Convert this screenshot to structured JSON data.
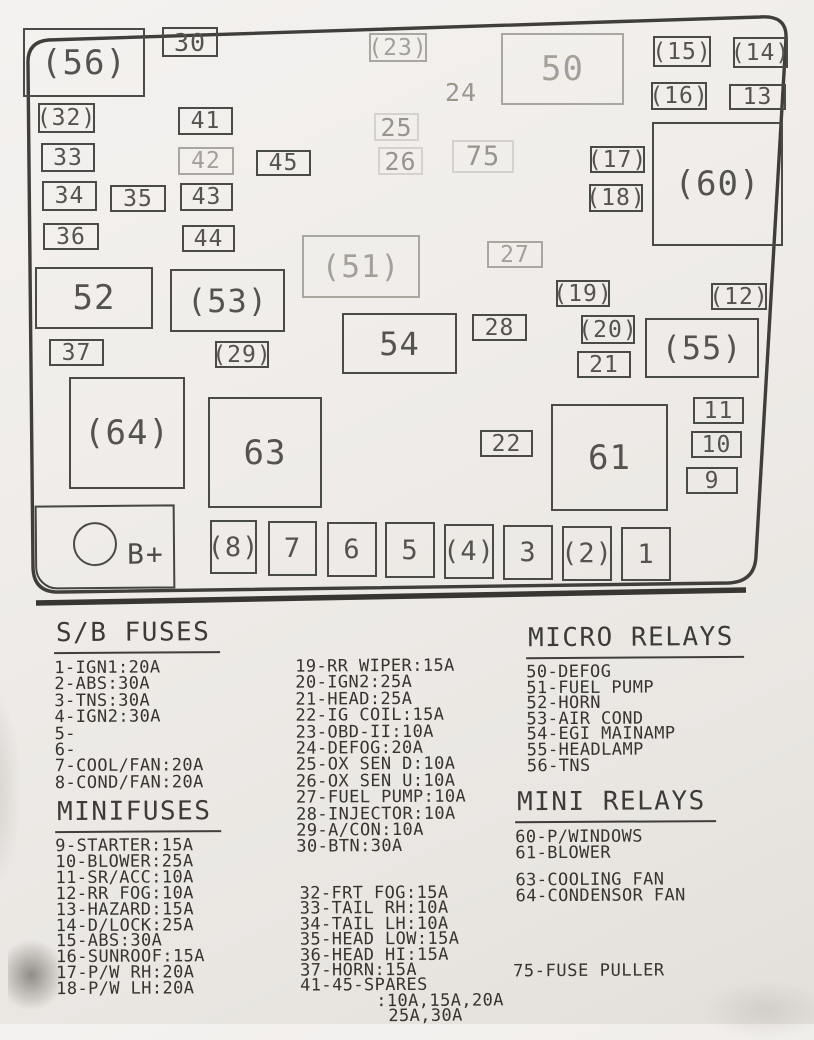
{
  "colors": {
    "ink": "#3f3d3a",
    "faint_ink": "#a3a09a",
    "paper": "#efece9"
  },
  "diagram": {
    "battery_label": "B+",
    "boxes": [
      {
        "label": "(56)",
        "x": 23,
        "y": 28,
        "w": 122,
        "h": 69,
        "fs": 34
      },
      {
        "label": "30",
        "x": 162,
        "y": 27,
        "w": 56,
        "h": 30,
        "fs": 25
      },
      {
        "label": "(23)",
        "x": 369,
        "y": 33,
        "w": 58,
        "h": 29,
        "fs": 23,
        "variant": "faint"
      },
      {
        "label": "24",
        "x": 440,
        "y": 78,
        "w": 42,
        "h": 28,
        "fs": 25,
        "variant": "text"
      },
      {
        "label": "50",
        "x": 501,
        "y": 33,
        "w": 123,
        "h": 72,
        "fs": 34,
        "variant": "faint"
      },
      {
        "label": "(15)",
        "x": 653,
        "y": 36,
        "w": 58,
        "h": 31,
        "fs": 23
      },
      {
        "label": "(14)",
        "x": 733,
        "y": 37,
        "w": 55,
        "h": 31,
        "fs": 23
      },
      {
        "label": "(16)",
        "x": 651,
        "y": 82,
        "w": 56,
        "h": 28,
        "fs": 23
      },
      {
        "label": "13",
        "x": 729,
        "y": 84,
        "w": 57,
        "h": 26,
        "fs": 23
      },
      {
        "label": "(32)",
        "x": 38,
        "y": 103,
        "w": 57,
        "h": 30,
        "fs": 23
      },
      {
        "label": "41",
        "x": 178,
        "y": 107,
        "w": 55,
        "h": 28,
        "fs": 23
      },
      {
        "label": "25",
        "x": 374,
        "y": 113,
        "w": 45,
        "h": 28,
        "fs": 25,
        "variant": "ghost"
      },
      {
        "label": "33",
        "x": 41,
        "y": 143,
        "w": 54,
        "h": 29,
        "fs": 23
      },
      {
        "label": "42",
        "x": 178,
        "y": 147,
        "w": 56,
        "h": 28,
        "fs": 23,
        "variant": "faint"
      },
      {
        "label": "45",
        "x": 256,
        "y": 150,
        "w": 55,
        "h": 26,
        "fs": 23
      },
      {
        "label": "26",
        "x": 378,
        "y": 147,
        "w": 45,
        "h": 28,
        "fs": 25,
        "variant": "ghost"
      },
      {
        "label": "75",
        "x": 452,
        "y": 140,
        "w": 62,
        "h": 33,
        "fs": 27,
        "variant": "ghost"
      },
      {
        "label": "(17)",
        "x": 590,
        "y": 146,
        "w": 55,
        "h": 27,
        "fs": 23
      },
      {
        "label": "(60)",
        "x": 652,
        "y": 122,
        "w": 131,
        "h": 124,
        "fs": 34
      },
      {
        "label": "34",
        "x": 42,
        "y": 181,
        "w": 55,
        "h": 30,
        "fs": 23
      },
      {
        "label": "35",
        "x": 110,
        "y": 185,
        "w": 56,
        "h": 27,
        "fs": 23
      },
      {
        "label": "43",
        "x": 180,
        "y": 183,
        "w": 53,
        "h": 28,
        "fs": 23
      },
      {
        "label": "(18)",
        "x": 589,
        "y": 184,
        "w": 54,
        "h": 28,
        "fs": 23
      },
      {
        "label": "36",
        "x": 43,
        "y": 223,
        "w": 56,
        "h": 27,
        "fs": 23
      },
      {
        "label": "44",
        "x": 182,
        "y": 225,
        "w": 53,
        "h": 27,
        "fs": 23
      },
      {
        "label": "(51)",
        "x": 302,
        "y": 235,
        "w": 118,
        "h": 63,
        "fs": 31,
        "variant": "faint"
      },
      {
        "label": "27",
        "x": 487,
        "y": 241,
        "w": 56,
        "h": 27,
        "fs": 23,
        "variant": "faint"
      },
      {
        "label": "52",
        "x": 35,
        "y": 267,
        "w": 118,
        "h": 62,
        "fs": 34
      },
      {
        "label": "(53)",
        "x": 170,
        "y": 269,
        "w": 115,
        "h": 63,
        "fs": 32
      },
      {
        "label": "(19)",
        "x": 556,
        "y": 280,
        "w": 54,
        "h": 27,
        "fs": 23
      },
      {
        "label": "(12)",
        "x": 711,
        "y": 283,
        "w": 56,
        "h": 27,
        "fs": 23
      },
      {
        "label": "28",
        "x": 472,
        "y": 314,
        "w": 55,
        "h": 27,
        "fs": 23
      },
      {
        "label": "54",
        "x": 342,
        "y": 313,
        "w": 115,
        "h": 61,
        "fs": 32
      },
      {
        "label": "(20)",
        "x": 581,
        "y": 315,
        "w": 54,
        "h": 29,
        "fs": 23
      },
      {
        "label": "(55)",
        "x": 645,
        "y": 318,
        "w": 114,
        "h": 60,
        "fs": 32
      },
      {
        "label": "37",
        "x": 49,
        "y": 339,
        "w": 55,
        "h": 27,
        "fs": 23
      },
      {
        "label": "(29)",
        "x": 215,
        "y": 341,
        "w": 54,
        "h": 27,
        "fs": 23
      },
      {
        "label": "21",
        "x": 577,
        "y": 351,
        "w": 54,
        "h": 27,
        "fs": 23
      },
      {
        "label": "(64)",
        "x": 69,
        "y": 377,
        "w": 116,
        "h": 112,
        "fs": 34
      },
      {
        "label": "63",
        "x": 208,
        "y": 397,
        "w": 114,
        "h": 111,
        "fs": 34
      },
      {
        "label": "11",
        "x": 693,
        "y": 397,
        "w": 51,
        "h": 27,
        "fs": 23
      },
      {
        "label": "22",
        "x": 480,
        "y": 430,
        "w": 53,
        "h": 27,
        "fs": 23
      },
      {
        "label": "61",
        "x": 551,
        "y": 404,
        "w": 117,
        "h": 107,
        "fs": 34
      },
      {
        "label": "10",
        "x": 691,
        "y": 431,
        "w": 51,
        "h": 27,
        "fs": 23
      },
      {
        "label": "9",
        "x": 686,
        "y": 467,
        "w": 52,
        "h": 27,
        "fs": 23
      },
      {
        "label": "(8)",
        "x": 210,
        "y": 520,
        "w": 47,
        "h": 54,
        "fs": 27
      },
      {
        "label": "7",
        "x": 268,
        "y": 521,
        "w": 49,
        "h": 55,
        "fs": 27
      },
      {
        "label": "6",
        "x": 327,
        "y": 522,
        "w": 50,
        "h": 55,
        "fs": 27
      },
      {
        "label": "5",
        "x": 385,
        "y": 522,
        "w": 50,
        "h": 56,
        "fs": 27
      },
      {
        "label": "(4)",
        "x": 444,
        "y": 524,
        "w": 50,
        "h": 55,
        "fs": 27
      },
      {
        "label": "3",
        "x": 503,
        "y": 525,
        "w": 50,
        "h": 55,
        "fs": 27
      },
      {
        "label": "(2)",
        "x": 562,
        "y": 526,
        "w": 50,
        "h": 55,
        "fs": 27
      },
      {
        "label": "1",
        "x": 621,
        "y": 527,
        "w": 50,
        "h": 54,
        "fs": 27
      }
    ]
  },
  "legend": {
    "sb_fuses": {
      "title": "S/B FUSES",
      "items": [
        "1-IGN1:20A",
        "2-ABS:30A",
        "3-TNS:30A",
        "4-IGN2:30A",
        "5-",
        "6-",
        "7-COOL/FAN:20A",
        "8-COND/FAN:20A"
      ]
    },
    "minifuses": {
      "title": "MINIFUSES",
      "items": [
        "9-STARTER:15A",
        "10-BLOWER:25A",
        "11-SR/ACC:10A",
        "12-RR FOG:10A",
        "13-HAZARD:15A",
        "14-D/LOCK:25A",
        "15-ABS:30A",
        "16-SUNROOF:15A",
        "17-P/W RH:20A",
        "18-P/W LH:20A"
      ]
    },
    "fuses_19_30": {
      "items": [
        "19-RR WIPER:15A",
        "20-IGN2:25A",
        "21-HEAD:25A",
        "22-IG COIL:15A",
        "23-OBD-II:10A",
        "24-DEFOG:20A",
        "25-OX SEN D:10A",
        "26-OX SEN U:10A",
        "27-FUEL PUMP:10A",
        "28-INJECTOR:10A",
        "29-A/CON:10A",
        "30-BTN:30A"
      ]
    },
    "fuses_32_45": {
      "items": [
        "32-FRT FOG:15A",
        "33-TAIL RH:10A",
        "34-TAIL LH:10A",
        "35-HEAD LOW:15A",
        "36-HEAD HI:15A",
        "37-HORN:15A",
        "41-45-SPARES",
        ":10A,15A,20A",
        "25A,30A"
      ]
    },
    "micro_relays": {
      "title": "MICRO RELAYS",
      "items": [
        "50-DEFOG",
        "51-FUEL PUMP",
        "52-HORN",
        "53-AIR COND",
        "54-EGI MAINAMP",
        "55-HEADLAMP",
        "56-TNS"
      ]
    },
    "mini_relays": {
      "title": "MINI RELAYS",
      "items": [
        "60-P/WINDOWS",
        "61-BLOWER"
      ]
    },
    "fans": {
      "items": [
        "63-COOLING FAN",
        "64-CONDENSOR FAN"
      ]
    },
    "fuse_puller": "75-FUSE PULLER"
  }
}
